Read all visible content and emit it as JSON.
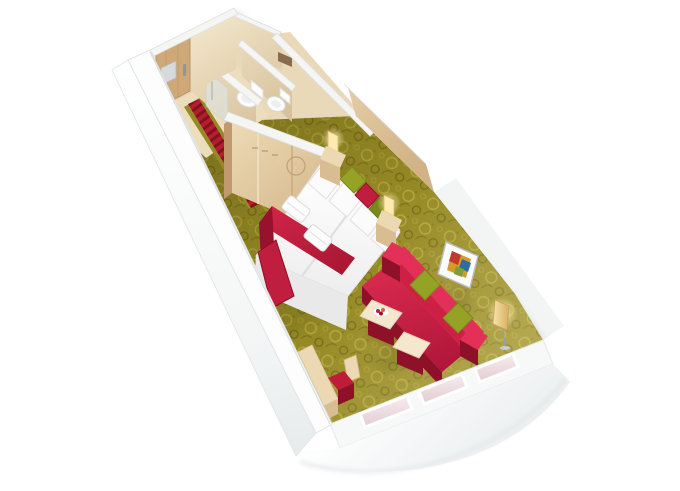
{
  "scene": {
    "name": "cruise-cabin-3d-floor-plan",
    "description": "Isometric cutaway render of a cabin: entrance door with corridor runner, shower and WC rooms, wardrobe, twin beds with red throw and towels, olive patterned carpet, red sofa with green cushions, coffee table with fruit bowl, ottoman, floor lamp, wall art, desk with chair, curved white hull with panorama windows"
  },
  "rooms": [
    {
      "label": "entrance-hall"
    },
    {
      "label": "shower-room"
    },
    {
      "label": "wc-room"
    },
    {
      "label": "washroom"
    },
    {
      "label": "bedroom"
    },
    {
      "label": "sitting-area"
    }
  ],
  "items": [
    {
      "label": "entrance-door",
      "color": "#cfa878"
    },
    {
      "label": "corridor-runner",
      "color": "#b51e30"
    },
    {
      "label": "toilet",
      "color": "#fcfcfc"
    },
    {
      "label": "shower-glass",
      "color": "#dfe7e9"
    },
    {
      "label": "wardrobe",
      "color": "#e3cda6"
    },
    {
      "label": "twin-beds",
      "color": "#fbfbfb"
    },
    {
      "label": "bed-throw",
      "color": "#c01e3e"
    },
    {
      "label": "towels",
      "color": "#fdfdfd"
    },
    {
      "label": "cushions",
      "color": "#94a326"
    },
    {
      "label": "nightstands",
      "color": "#e8d5ae"
    },
    {
      "label": "wall-sconces",
      "color": "#ffeab0"
    },
    {
      "label": "carpet",
      "color": "#968a26"
    },
    {
      "label": "sofa",
      "color": "#ce1f44"
    },
    {
      "label": "coffee-table",
      "color": "#f4e7cd"
    },
    {
      "label": "ottoman",
      "color": "#f4e7cd"
    },
    {
      "label": "floor-lamp",
      "color": "#d4ad5f"
    },
    {
      "label": "wall-art",
      "color": "#c0392b"
    },
    {
      "label": "desk",
      "color": "#eedbb6"
    },
    {
      "label": "desk-chair",
      "color": "#c01b38"
    },
    {
      "label": "panorama-windows",
      "color": "#f2e2e6"
    }
  ],
  "colors": {
    "bg": "#ffffff",
    "wall-cap": "#f5f5f3",
    "wall-edge": "#d9dcdd",
    "hull-light": "#fdfdfd",
    "hull-shade": "#e9eced",
    "wall-beige": "#ead9b7",
    "wall-beige-dark": "#d8c096",
    "wood-light": "#ecd8b2",
    "wood-mid": "#d9bd92",
    "wood-dark": "#c09a6e",
    "door-wood": "#cfa878",
    "plaque-silver": "#d6dadd",
    "carpet-base": "#968a26",
    "carpet-light": "#b7aa40",
    "carpet-dark": "#6d6313",
    "runner-red": "#b51e30",
    "runner-dark": "#841120",
    "bed-white": "#fbfbfb",
    "bed-shade": "#e6e6e6",
    "throw-red": "#c01e3e",
    "throw-dark": "#97122d",
    "green": "#94a326",
    "green-dark": "#79881c",
    "sofa-bright": "#e23058",
    "sofa-red": "#ce1f44",
    "sofa-dark": "#8f1129",
    "cream": "#f4e7cd",
    "glow": "#ffeab0",
    "gold": "#d4ad5f",
    "metal": "#9aa0a4",
    "fixture-white": "#fcfcfc",
    "glass-pink": "#f2e2e6",
    "art-red": "#c0392b",
    "art-blue": "#2e6da4",
    "art-gold": "#d29b2a",
    "art-green": "#7f9c3a"
  }
}
